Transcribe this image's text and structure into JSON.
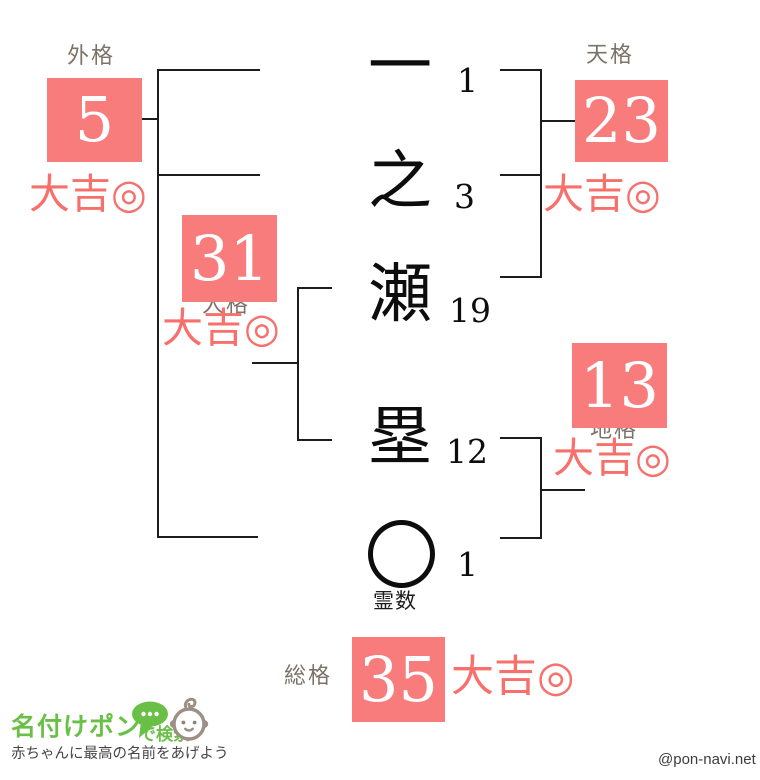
{
  "colors": {
    "box_salmon": "#f87c7c",
    "result_salmon": "#f8706c",
    "label_grey": "#7b7268",
    "line_black": "#1c1c1c",
    "logo_green": "#6ac047",
    "baby_grey": "#9c9086",
    "tagline_grey": "#464646",
    "credit_grey": "#3c3c3c"
  },
  "name": {
    "characters": [
      {
        "glyph": "一",
        "strokes": "1"
      },
      {
        "glyph": "之",
        "strokes": "3"
      },
      {
        "glyph": "瀬",
        "strokes": "19"
      },
      {
        "glyph": "塁",
        "strokes": "12"
      }
    ],
    "spirit": {
      "strokes": "1",
      "label": "霊数"
    }
  },
  "kaku": {
    "gaikaku": {
      "label": "外格",
      "value": "5",
      "result": "大吉◎"
    },
    "tenkaku": {
      "label": "天格",
      "value": "23",
      "result": "大吉◎"
    },
    "jinkaku": {
      "label": "人格",
      "value": "31",
      "result": "大吉◎"
    },
    "chikaku": {
      "label": "地格",
      "value": "13",
      "result": "大吉◎"
    },
    "soukaku": {
      "label": "総格",
      "value": "35",
      "result": "大吉◎"
    }
  },
  "footer": {
    "brand": "名付けポン",
    "brand_suffix": "で検索",
    "tagline": "赤ちゃんに最高の名前をあげよう",
    "credit": "@pon-navi.net"
  }
}
